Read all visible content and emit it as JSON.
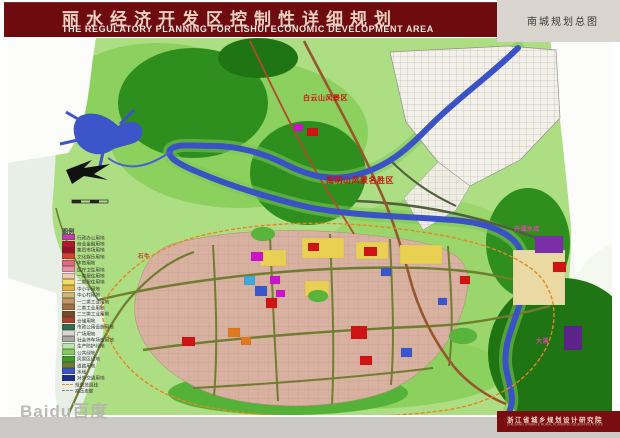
{
  "header": {
    "title_zh": "丽水经济开发区控制性详细规划",
    "title_en": "THE REGULATORY PLANNING FOR LISHUI ECONOMIC DEVELOPMENT AREA"
  },
  "corner_label": "南城规划总图",
  "watermark": "Baidu百度",
  "legend": {
    "title": "图例",
    "items": [
      {
        "label": "行政办公用地",
        "color": "#c040a8"
      },
      {
        "label": "商业金融用地",
        "color": "#b81430"
      },
      {
        "label": "集贸市场用地",
        "color": "#981028"
      },
      {
        "label": "文化娱乐用地",
        "color": "#d84030"
      },
      {
        "label": "体育用地",
        "color": "#e06880"
      },
      {
        "label": "医疗卫生用地",
        "color": "#e890a0"
      },
      {
        "label": "一类居住用地",
        "color": "#f0cab4"
      },
      {
        "label": "二类居住用地",
        "color": "#eee066"
      },
      {
        "label": "中小学用地",
        "color": "#e8b23e"
      },
      {
        "label": "中心村用地",
        "color": "#d2b478"
      },
      {
        "label": "一二类工业用地",
        "color": "#c09a62"
      },
      {
        "label": "二类工业用地",
        "color": "#a07040"
      },
      {
        "label": "二三类工业用地",
        "color": "#744c2c"
      },
      {
        "label": "仓储用地",
        "color": "#a84028"
      },
      {
        "label": "市政公用设施用地",
        "color": "#2c6e4e"
      },
      {
        "label": "广场用地",
        "color": "#d8d8d0"
      },
      {
        "label": "社会停车场库用地",
        "color": "#a8a8a0"
      },
      {
        "label": "生产防护绿地",
        "color": "#bce4b0"
      },
      {
        "label": "公共绿地",
        "color": "#84cc5c"
      },
      {
        "label": "风景区绿地",
        "color": "#3c9c28"
      },
      {
        "label": "道路用地",
        "color": "#6e7c30"
      },
      {
        "label": "水域",
        "color": "#3c54c8"
      },
      {
        "label": "对外交通用地",
        "color": "#1c2c88"
      },
      {
        "label": "规划范围线",
        "color": "#e08820",
        "dash": true
      },
      {
        "label": "高压走廊",
        "color": "#888888",
        "dash": true
      }
    ]
  },
  "map_labels": [
    {
      "text": "白云山风景区",
      "x": 295,
      "y": 55,
      "color": "#cc1010",
      "size": 7
    },
    {
      "text": "南明山风景名胜区",
      "x": 318,
      "y": 137,
      "color": "#cc1010",
      "size": 8
    },
    {
      "text": "石牛",
      "x": 130,
      "y": 214,
      "color": "#d23030",
      "size": 5.5
    },
    {
      "text": "开潭水库",
      "x": 506,
      "y": 186,
      "color": "#d848a0",
      "size": 6
    },
    {
      "text": "大溪",
      "x": 528,
      "y": 298,
      "color": "#d848a0",
      "size": 6
    }
  ],
  "footer": {
    "institute_zh": "浙江省城乡规划设计研究院",
    "institute_en": "ZHEJIANG URBAN & RURAL PLANNING DESIGN INSTITUTE"
  },
  "colors": {
    "header_bg": "#6e0b0e",
    "river": "#3a52c6",
    "road_olive": "#6f7d2f",
    "boundary_orange": "#e5881f",
    "planned_area": "#d8b1a1"
  }
}
